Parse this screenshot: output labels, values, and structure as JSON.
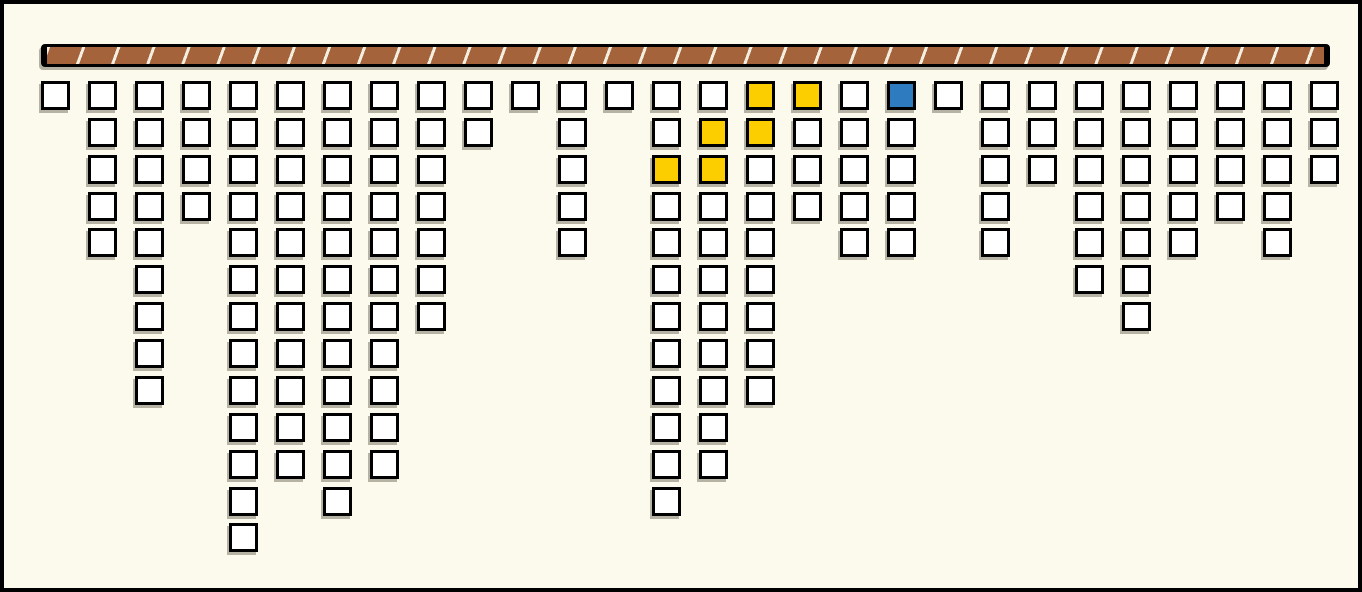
{
  "board": {
    "columns": 28,
    "max_rows": 13,
    "column_heights": [
      1,
      5,
      9,
      4,
      13,
      11,
      12,
      11,
      7,
      2,
      1,
      5,
      1,
      12,
      11,
      9,
      4,
      5,
      5,
      1,
      5,
      3,
      6,
      7,
      5,
      4,
      5,
      3
    ],
    "special_cells": [
      {
        "col": 16,
        "row": 1,
        "color": "yellow"
      },
      {
        "col": 17,
        "row": 1,
        "color": "yellow"
      },
      {
        "col": 19,
        "row": 1,
        "color": "blue"
      },
      {
        "col": 15,
        "row": 2,
        "color": "yellow"
      },
      {
        "col": 16,
        "row": 2,
        "color": "yellow"
      },
      {
        "col": 14,
        "row": 3,
        "color": "yellow"
      },
      {
        "col": 15,
        "row": 3,
        "color": "yellow"
      }
    ],
    "colors": {
      "background": "#fcfaec",
      "block_fill": "#ffffff",
      "block_border": "#000000",
      "yellow": "#fcce00",
      "blue": "#2e7cbf",
      "bar_fill": "#a5633c",
      "bar_stripe": "#f2eee0",
      "shadow": "#b6b2a4"
    }
  }
}
